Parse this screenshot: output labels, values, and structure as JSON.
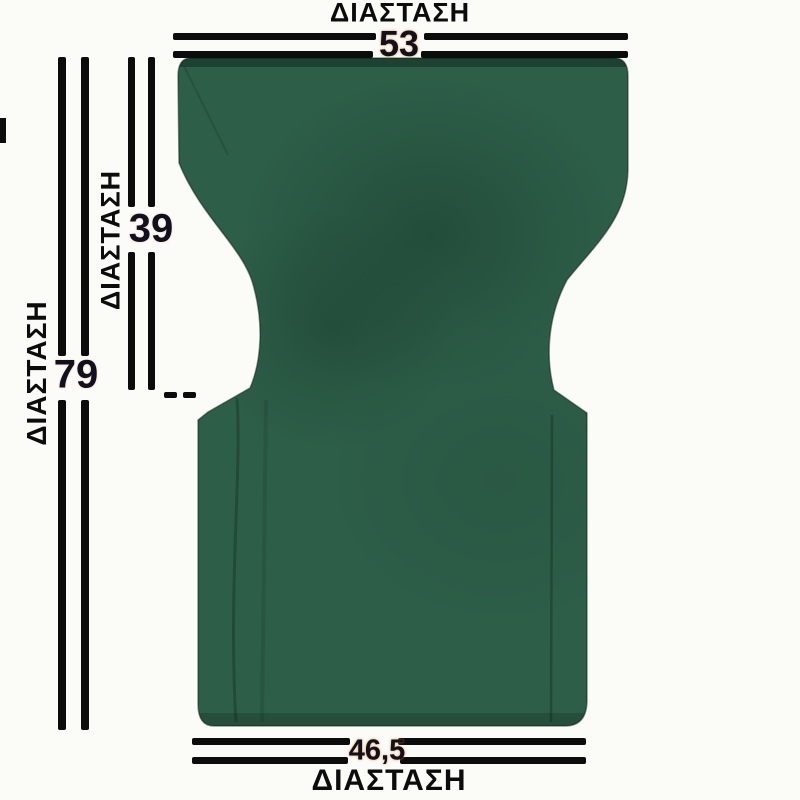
{
  "theme": {
    "line": "#0c0c0c",
    "fabric": "#2d5e48",
    "fabric-shade": "#1e4634",
    "number": "#10101e",
    "number-glow": "#d9882a",
    "bg": "#fbfbf8"
  },
  "diagram": {
    "subject": "director-chair-replacement-fabric",
    "fabric_color_hex": "#2d5e48",
    "dimensions": {
      "top_width": {
        "label": "ΔΙΑΣΤΑΣΗ",
        "value": "53"
      },
      "total_height": {
        "label": "ΔΙΑΣΤΑΣΗ",
        "value": "79"
      },
      "back_height": {
        "label": "ΔΙΑΣΤΑΣΗ",
        "value": "39"
      },
      "bottom_width": {
        "label": "ΔΙΑΣΤΑΣΗ",
        "value": "46,5"
      }
    }
  }
}
